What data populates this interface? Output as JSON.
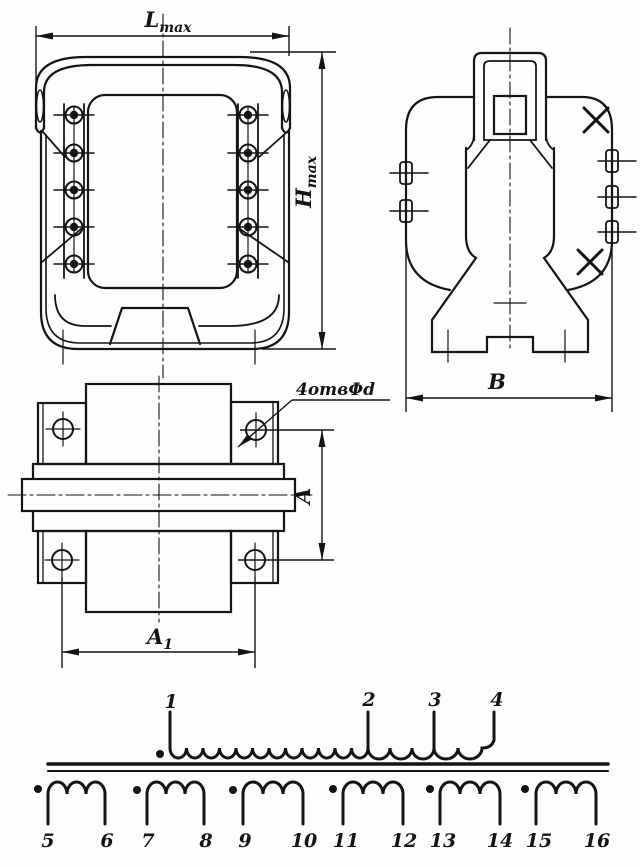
{
  "drawing": {
    "title": "transformer-outline-drawing",
    "ink_color": "#141414",
    "background": "#fdfdfb",
    "dimensions": {
      "length": {
        "main": "L",
        "sub": "max"
      },
      "height": {
        "main": "H",
        "sub": "max"
      },
      "hole_pitch_vertical": "A",
      "hole_pitch_horizontal": {
        "main": "A",
        "sub": "1"
      },
      "width": "В",
      "holes_note": "4отвΦd"
    },
    "schematic": {
      "primary_taps": [
        "1",
        "2",
        "3",
        "4"
      ],
      "secondary_terminals": [
        "5",
        "6",
        "7",
        "8",
        "9",
        "10",
        "11",
        "12",
        "13",
        "14",
        "15",
        "16"
      ]
    }
  }
}
